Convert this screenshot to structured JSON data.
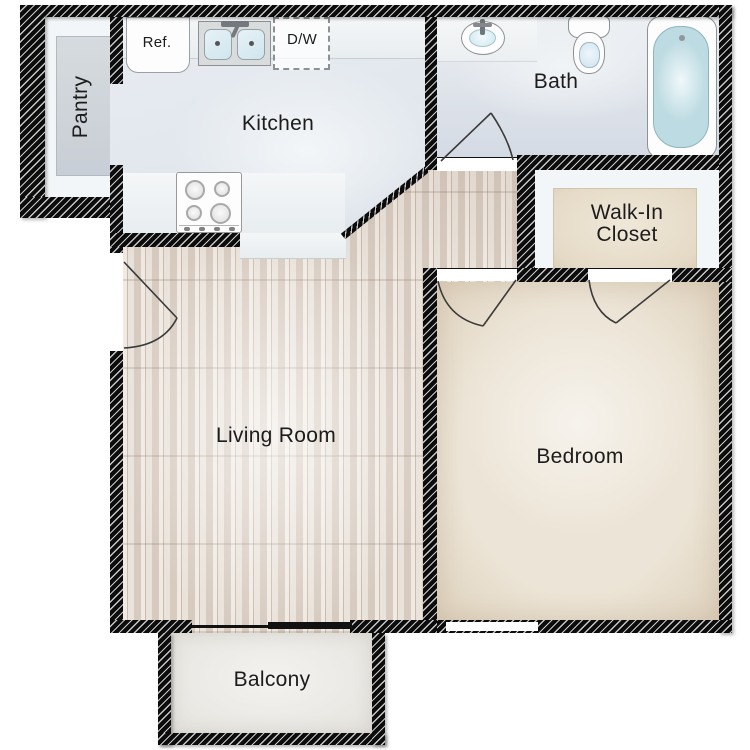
{
  "labels": {
    "pantry": "Pantry",
    "kitchen": "Kitchen",
    "ref": "Ref.",
    "dw": "D/W",
    "bath": "Bath",
    "walkin_line1": "Walk-In",
    "walkin_line2": "Closet",
    "living": "Living Room",
    "bedroom": "Bedroom",
    "balcony": "Balcony"
  },
  "colors": {
    "wall": "#0c0c0c",
    "hatch": "#c8c8c8",
    "door_line": "#3a3a3a",
    "kitchen_floor": "#e6ebf0",
    "bath_floor": "#e3e7ee",
    "wood_floor": "#d9cec4",
    "bedroom_floor": "#e9e1d3",
    "closet_floor": "#e9e0d0",
    "balcony_floor": "#edece8",
    "pantry_floor": "#cfd4da",
    "fixture_outline": "#8c9194",
    "water_blue": "#c3dfe8"
  }
}
